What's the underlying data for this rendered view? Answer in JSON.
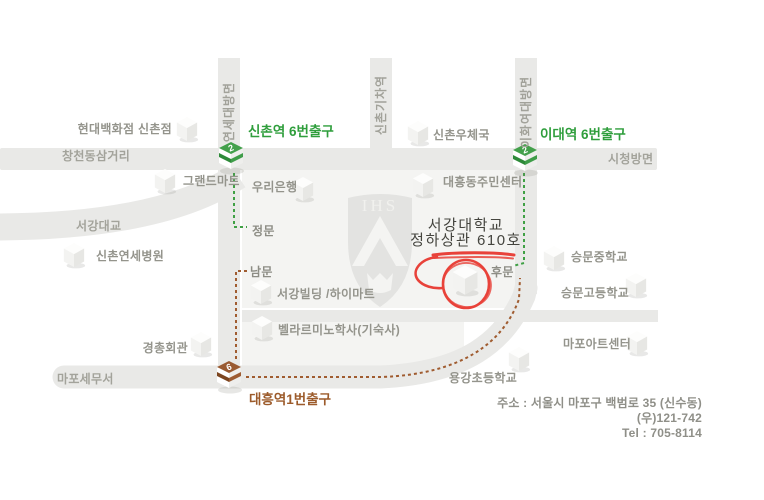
{
  "colors": {
    "line2_green": "#3fa047",
    "line6_brown": "#9a5b33",
    "highlight_red": "#e8423a"
  },
  "stations": {
    "sinchon": {
      "label": "신촌역 6번출구",
      "line": "2"
    },
    "edae": {
      "label": "이대역 6번출구",
      "line": "2"
    },
    "daeheung": {
      "label": "대흥역1번출구",
      "line": "6"
    }
  },
  "roads": {
    "yonsei_dir": "연세대방면",
    "sinchon_rail": "신촌기차역",
    "ewha_dir": "이화여대방면",
    "changcheon": "창천동삼거리",
    "cityhall_dir": "시청방면",
    "sogang_bridge": "서강대교",
    "mapo_tax": "마포세무서"
  },
  "gates": {
    "main": "정문",
    "south": "남문",
    "back": "후문"
  },
  "buildings": {
    "hyundai": "현대백화점 신촌점",
    "grandmart": "그랜드마트",
    "yonsei_hosp": "신촌연세병원",
    "kyungchong": "경총회관",
    "woori": "우리은행",
    "post": "신촌우체국",
    "daeheung_center": "대흥동주민센터",
    "sogang_bldg": "서강빌딩 /하이마트",
    "bellarmino": "벨라르미노학사(기숙사)",
    "seungmun_mid": "승문중학교",
    "seungmun_high": "승문고등학교",
    "mapo_art": "마포아트센터",
    "yonggang": "용강초등학교"
  },
  "destination": {
    "line1": "서강대학교",
    "line2": "정하상관 610호"
  },
  "emblem": "IHS",
  "address": {
    "line1": "주소 : 서울시 마포구 백범로 35 (신수동)",
    "line2": "(우)121-742",
    "line3": "Tel : 705-8114"
  }
}
